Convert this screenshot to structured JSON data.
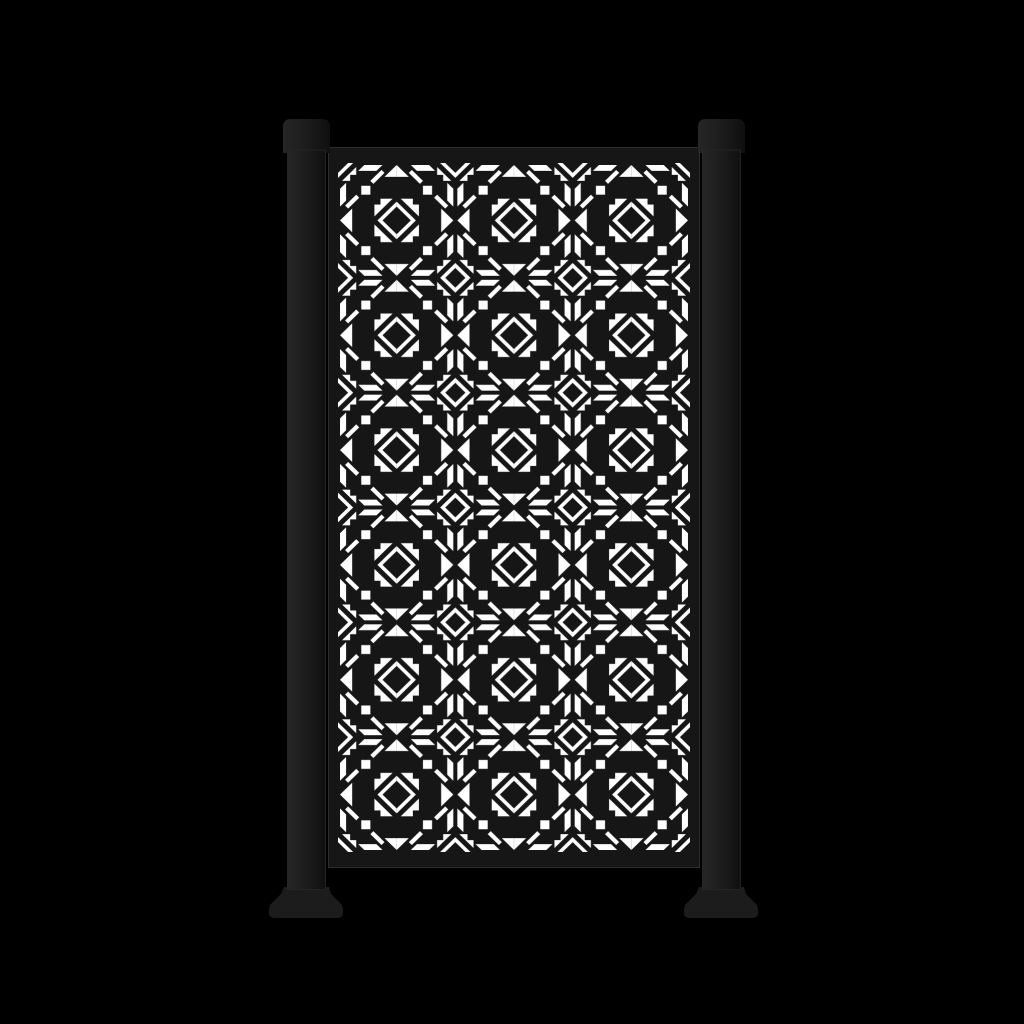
{
  "scene": {
    "subject": "black-metal-privacy-screen-panel-with-two-posts",
    "background_color": "#000000"
  },
  "colors": {
    "background": "#000000",
    "panel": "#161616",
    "panel_edge": "#2e2e2e",
    "post": "#1c1c1c",
    "post_highlight": "#262626",
    "post_shadow": "#0f0f0f",
    "post_edge": "#272727",
    "cutout": "#ffffff"
  },
  "panel": {
    "pattern_columns": 6,
    "pattern_rows": 12,
    "pattern_style": "geometric-arrow-lattice-cutout"
  },
  "posts": {
    "count": 2,
    "cap_style": "rounded-flat-cap",
    "foot_style": "flared-base-foot"
  }
}
